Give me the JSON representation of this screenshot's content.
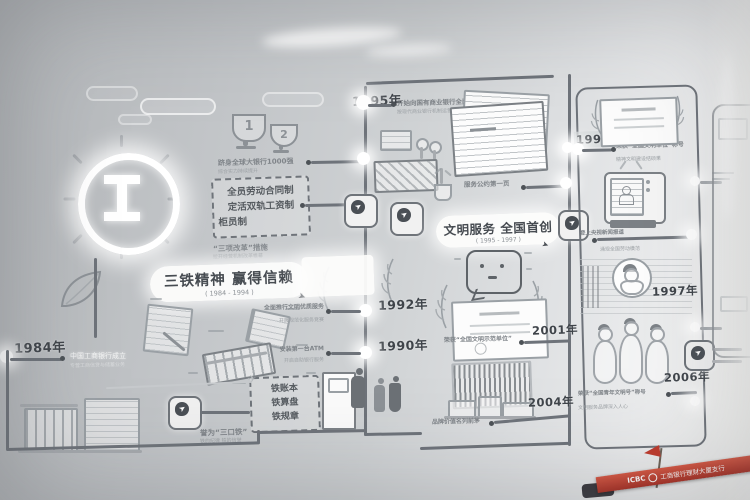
{
  "icons": {
    "pointer": "➤",
    "plane": "✈"
  },
  "sign": {
    "brand": "ICBC",
    "name": "工商银行理财大厦支行"
  },
  "era1": {
    "banner": {
      "title": "三铁精神 赢得信赖",
      "years": "( 1984 - 1994 )"
    },
    "trophy": {
      "rank1": "1",
      "rank2": "2",
      "caption": "跻身全球大银行1000强",
      "caption_sub": "综合实力持续提升"
    },
    "reform": {
      "l1": "全员劳动合同制",
      "l2": "定活双轨工资制",
      "l3": "柜员制",
      "caption": "“三项改革”措施",
      "caption_sub": "拉开经营机制改革帷幕"
    },
    "iron": {
      "l1": "铁账本",
      "l2": "铁算盘",
      "l3": "铁规章",
      "caption": "誉为“三口铁”",
      "caption_sub": "铁的纪律 铁的信誉"
    },
    "e1984": {
      "year": "1984年",
      "caption": "中国工商银行成立",
      "caption_sub": "专营工商信贷与储蓄业务"
    }
  },
  "era2": {
    "banner": {
      "title": "文明服务 全国首创",
      "years": "( 1995 - 1997 )"
    },
    "e1995": {
      "year": "1995年",
      "caption": "开始向国有商业银行全面转轨",
      "caption_sub": "按现代商业银行机制运营"
    },
    "docs": {
      "caption": "服务公约第一页"
    },
    "e1992": {
      "year": "1992年",
      "caption": "全面推行文明优质服务",
      "caption_sub": "开展规范化服务竞赛"
    },
    "e1990": {
      "year": "1990年",
      "caption": "安装第一台ATM",
      "caption_sub": "开启自助银行服务"
    },
    "e2001": {
      "year": "2001年",
      "caption": "荣获“全国文明示范单位”"
    },
    "e2004": {
      "year": "2004年",
      "caption": "品牌价值名列前茅"
    }
  },
  "era3": {
    "e1996": {
      "year": "1996年",
      "caption": "荣获“全国文明单位”称号",
      "caption_sub": "精神文明建设结硕果"
    },
    "tv": {
      "caption": "登上央视新闻报道"
    },
    "e1997": {
      "year": "1997年"
    },
    "portrait": {
      "caption": "涌现全国劳动模范"
    },
    "e2006": {
      "year": "2006年",
      "caption": "荣获“全国青年文明号”称号",
      "caption_sub": "文明服务品牌深入人心"
    }
  }
}
